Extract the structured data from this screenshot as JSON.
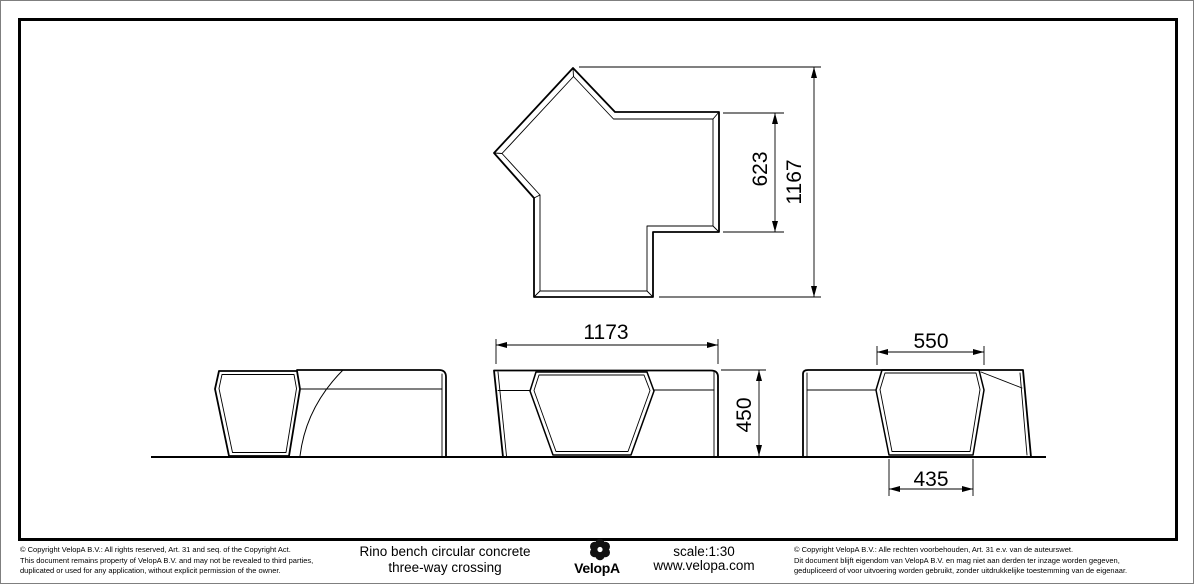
{
  "title_block": {
    "copyright_en": [
      "©  Copyright VelopA B.V.: All rights reserved, Art. 31 and seq. of the Copyright Act.",
      "This document remains property of VelopA B.V. and may not be revealed to third parties,",
      "duplicated or used for any application, without explicit permission of the owner."
    ],
    "copyright_nl": [
      "©  Copyright VelopA B.V.: Alle rechten voorbehouden, Art. 31 e.v. van de auteurswet.",
      "Dit document blijft eigendom van VelopA B.V. en mag niet aan derden ter inzage worden gegeven,",
      "gedupliceerd of voor uitvoering worden gebruikt, zonder uitdrukkelijke toestemming van de eigenaar."
    ],
    "product_title_line1": "Rino bench circular concrete",
    "product_title_line2": "three-way crossing",
    "brand": "VelopA",
    "scale_label": "scale:1:30",
    "website": "www.velopa.com"
  },
  "dimensions": {
    "top_view": {
      "arm_end_width": "623",
      "overall_depth": "1167"
    },
    "front_elevation": {
      "overall_width": "1173",
      "height": "450"
    },
    "side_elevation": {
      "top_width": "550",
      "base_width": "435"
    }
  },
  "colors": {
    "line": "#000000",
    "background": "#ffffff",
    "page_edge": "#7f7f7f"
  }
}
